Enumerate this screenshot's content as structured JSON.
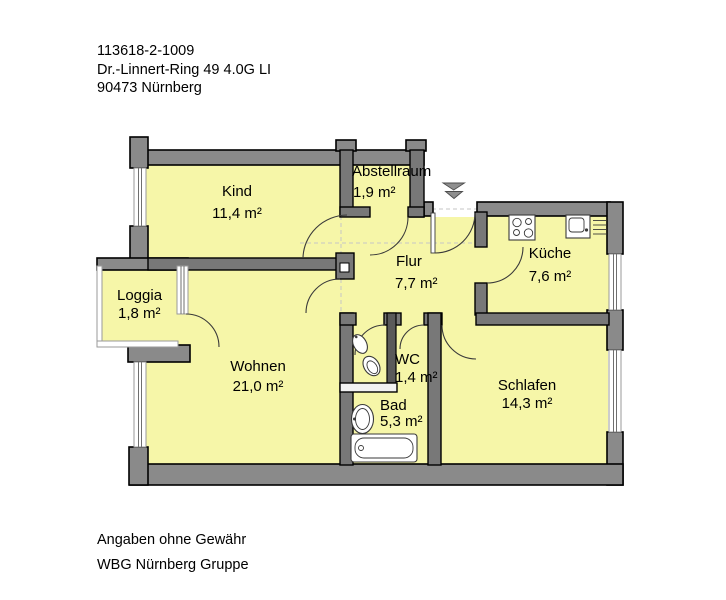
{
  "header": {
    "line1": "113618-2-1009",
    "line2": "Dr.-Linnert-Ring 49 4.0G LI",
    "line3": "90473 Nürnberg"
  },
  "footer": {
    "line1": "Angaben ohne Gewähr",
    "line2": "WBG Nürnberg Gruppe"
  },
  "rooms": {
    "kind": {
      "name": "Kind",
      "area": "11,4 m²"
    },
    "abstellraum": {
      "name": "Abstellraum",
      "area": "1,9 m²"
    },
    "flur": {
      "name": "Flur",
      "area": "7,7 m²"
    },
    "kueche": {
      "name": "Küche",
      "area": "7,6 m²"
    },
    "loggia": {
      "name": "Loggia",
      "area": "1,8 m²"
    },
    "wohnen": {
      "name": "Wohnen",
      "area": "21,0 m²"
    },
    "wc": {
      "name": "WC",
      "area": "1,4 m²"
    },
    "bad": {
      "name": "Bad",
      "area": "5,3 m²"
    },
    "schlafen": {
      "name": "Schlafen",
      "area": "14,3 m²"
    }
  },
  "icons": {
    "entrance": "entrance-arrow-icon",
    "kitchen_stove": "stove-icon",
    "kitchen_sink": "sink-icon",
    "wc_toilet": "toilet-icon",
    "wc_basin": "corner-basin-icon",
    "bath_basin": "washbasin-icon",
    "bath_tub": "bathtub-icon"
  },
  "colors": {
    "room_fill": "#f6f6a8",
    "wall_exterior": "#8a8a8a",
    "wall_interior": "#787878",
    "outline": "#000000",
    "background": "#ffffff",
    "window_line": "#6f6f6f",
    "dashed_reference": "#c6c6c6"
  }
}
